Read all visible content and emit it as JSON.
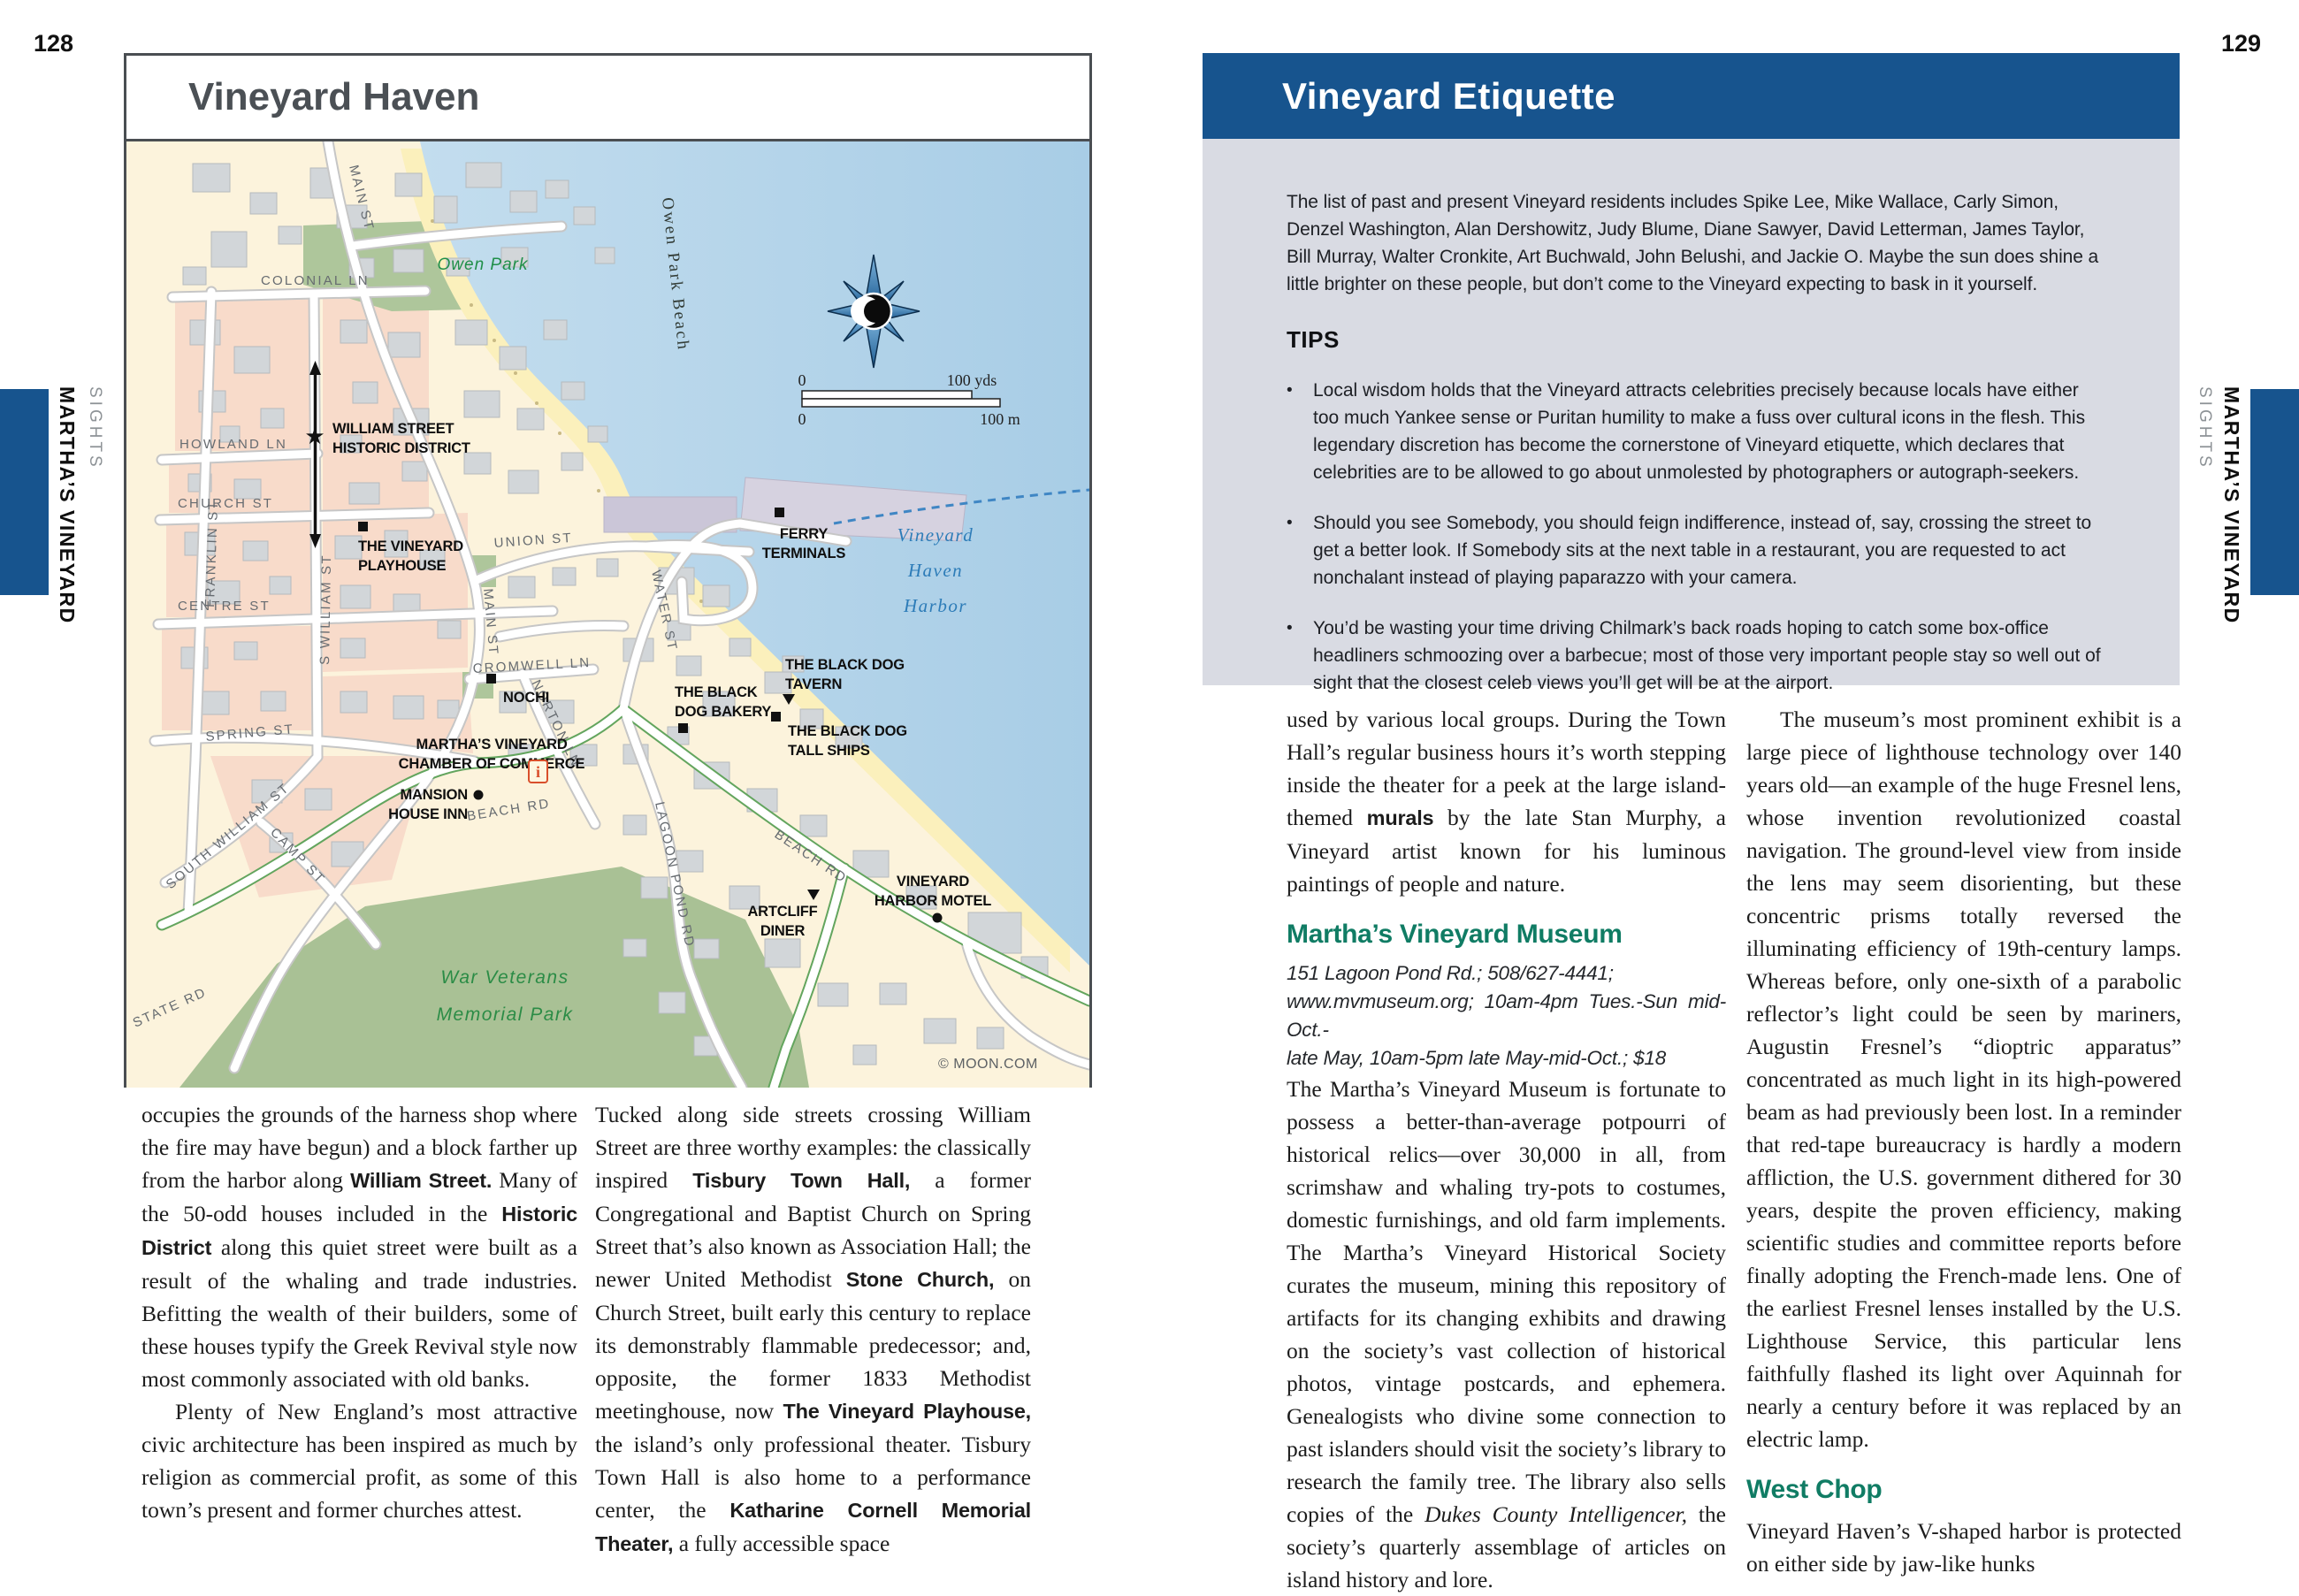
{
  "colors": {
    "accent_blue": "#17548e",
    "teal_heading": "#107c64",
    "box_bg": "#d9dbe3",
    "map_water": "#b9d8ec",
    "map_land": "#fcf3dc",
    "map_pink": "#f8dbca",
    "map_park": "#aec69b"
  },
  "pages": {
    "left_number": "128",
    "right_number": "129"
  },
  "side_tabs": {
    "left": {
      "chapter": "MARTHA’S VINEYARD",
      "section": "SIGHTS"
    },
    "right": {
      "chapter": "MARTHA’S VINEYARD",
      "section": "SIGHTS"
    }
  },
  "map": {
    "title": "Vineyard Haven",
    "copyright": "© MOON.COM",
    "scale": {
      "yds0": "0",
      "yds": "100 yds",
      "m0": "0",
      "m": "100 m"
    },
    "streets": {
      "main_top": "MAIN ST",
      "colonial": "COLONIAL LN",
      "howland": "HOWLAND LN",
      "church": "CHURCH ST",
      "franklin": "FRANKLIN ST",
      "centre": "CENTRE ST",
      "spring": "SPRING ST",
      "s_william": "S WILLIAM ST",
      "south_william": "SOUTH WILLIAM ST",
      "camp": "CAMP ST",
      "main_lower": "MAIN ST",
      "union": "UNION ST",
      "cromwell": "CROMWELL LN",
      "norton": "NORTON LN",
      "water": "WATER ST",
      "lagoon": "LAGOON POND RD",
      "beach_up": "BEACH RD",
      "beach_low": "BEACH RD",
      "state": "STATE RD"
    },
    "pois": {
      "historic_district": [
        "WILLIAM STREET",
        "HISTORIC DISTRICT"
      ],
      "playhouse": [
        "THE VINEYARD",
        "PLAYHOUSE"
      ],
      "ferry": [
        "FERRY",
        "TERMINALS"
      ],
      "nochi": [
        "NOCHI"
      ],
      "chamber": [
        "MARTHA’S VINEYARD",
        "CHAMBER OF COMMERCE"
      ],
      "mansion": [
        "MANSION",
        "HOUSE INN"
      ],
      "tavern": [
        "THE BLACK DOG",
        "TAVERN"
      ],
      "bakery": [
        "THE BLACK",
        "DOG BAKERY"
      ],
      "tall_ships": [
        "THE BLACK DOG",
        "TALL SHIPS"
      ],
      "artcliff": [
        "ARTCLIFF",
        "DINER"
      ],
      "motel": [
        "VINEYARD",
        "HARBOR MOTEL"
      ]
    },
    "areas": {
      "owen_park": "Owen Park",
      "owen_park_beach": "Owen Park Beach",
      "war_memorial": [
        "War Veterans",
        "Memorial Park"
      ],
      "harbor": [
        "Vineyard",
        "Haven",
        "Harbor"
      ]
    }
  },
  "etiquette_box": {
    "title": "Vineyard Etiquette",
    "intro": "The list of past and present Vineyard residents includes Spike Lee, Mike Wallace, Carly Simon, Denzel Washington, Alan Dershowitz, Judy Blume, Diane Sawyer, David Letterman, James Taylor, Bill Murray, Walter Cronkite, Art Buchwald, John Belushi, and Jackie O. Maybe the sun does shine a little brighter on these people, but don’t come to the Vineyard expecting to bask in it yourself.",
    "tips_heading": "TIPS",
    "bullet": "•",
    "tips": [
      "Local wisdom holds that the Vineyard attracts celebrities precisely because locals have either too much Yankee sense or Puritan humility to make a fuss over cultural icons in the flesh. This legendary discretion has become the cornerstone of Vineyard etiquette, which declares that celebrities are to be allowed to go about unmolested by photographers or autograph-seekers.",
      "Should you see Somebody, you should feign indifference, instead of, say, crossing the street to get a better look. If Somebody sits at the next table in a restaurant, you are requested to act nonchalant instead of playing paparazzo with your camera.",
      "You’d be wasting your time driving Chilmark’s back roads hoping to catch some box-office headliners schmoozing over a barbecue; most of those very important people stay so well out of sight that the closest celeb views you’ll get will be at the airport."
    ]
  },
  "left_page": {
    "col1_p1": [
      {
        "t": "occupies the grounds of the harness shop where the fire may have begun) and a block farther up from the harbor along ",
        "s": ""
      },
      {
        "t": "William Street.",
        "s": "b"
      },
      {
        "t": " Many of the 50-odd houses included in the ",
        "s": ""
      },
      {
        "t": "Historic District",
        "s": "b"
      },
      {
        "t": " along this quiet street were built as a result of the whaling and trade industries. Befitting the wealth of their builders, some of these houses typify the Greek Revival style now most commonly associated with old banks.",
        "s": ""
      }
    ],
    "col1_p2": [
      {
        "t": "Plenty of New England’s most attractive civic architecture has been inspired as much by religion as commercial profit, as some of this town’s present and former churches attest.",
        "s": ""
      }
    ],
    "col2_p1": [
      {
        "t": "Tucked along side streets crossing William Street are three worthy examples: the classically inspired ",
        "s": ""
      },
      {
        "t": "Tisbury Town Hall,",
        "s": "b"
      },
      {
        "t": " a former Congregational and Baptist Church on Spring Street that’s also known as Association Hall; the newer United Methodist ",
        "s": ""
      },
      {
        "t": "Stone Church,",
        "s": "b"
      },
      {
        "t": " on Church Street, built early this century to replace its demonstrably flammable predecessor; and, opposite, the former 1833 Methodist meetinghouse, now ",
        "s": ""
      },
      {
        "t": "The Vineyard Playhouse,",
        "s": "b"
      },
      {
        "t": " the island’s only professional theater. Tisbury Town Hall is also home to a performance center, the ",
        "s": ""
      },
      {
        "t": "Katharine Cornell Memorial Theater,",
        "s": "b"
      },
      {
        "t": " a fully accessible space",
        "s": ""
      }
    ]
  },
  "right_page": {
    "col1_p1": [
      {
        "t": "used by various local groups. During the Town Hall’s regular business hours it’s worth stepping inside the theater for a peek at the large island-themed ",
        "s": ""
      },
      {
        "t": "murals",
        "s": "b"
      },
      {
        "t": " by the late Stan Murphy, a Vineyard artist known for his luminous paintings of people and nature.",
        "s": ""
      }
    ],
    "museum_heading": "Martha’s Vineyard Museum",
    "museum_info": [
      "151 Lagoon Pond Rd.; 508/627-4441;",
      "www.mvmuseum.org; 10am-4pm Tues.-Sun mid-Oct.-",
      "late May, 10am-5pm late May-mid-Oct.; $18"
    ],
    "col1_p2": [
      {
        "t": "The Martha’s Vineyard Museum is fortunate to possess a better-than-average potpourri of historical relics—over 30,000 in all, from scrimshaw and whaling try-pots to costumes, domestic furnishings, and old farm implements. The Martha’s Vineyard Historical Society curates the museum, mining this repository of artifacts for its changing exhibits and drawing on the society’s vast collection of historical photos, vintage postcards, and ephemera. Genealogists who divine some connection to past islanders should visit the society’s library to research the family tree. The library also sells copies of the ",
        "s": ""
      },
      {
        "t": "Dukes County Intelligencer,",
        "s": "i"
      },
      {
        "t": " the society’s quarterly assemblage of articles on island history and lore.",
        "s": ""
      }
    ],
    "col2_p1": [
      {
        "t": "The museum’s most prominent exhibit is a large piece of lighthouse technology over 140 years old—an example of the huge Fresnel lens, whose invention revolutionized coastal navigation. The ground-level view from inside the lens may seem disorienting, but these concentric prisms totally reversed the illuminating efficiency of 19th-century lamps. Whereas before, only one-sixth of a parabolic reflector’s light could be seen by mariners, Augustin Fresnel’s “dioptric apparatus” concentrated as much light in its high-powered beam as had previously been lost. In a reminder that red-tape bureaucracy is hardly a modern affliction, the U.S. government dithered for 30 years, despite the proven efficiency, making scientific studies and committee reports before finally adopting the French-made lens. One of the earliest Fresnel lenses installed by the U.S. Lighthouse Service, this particular lens faithfully flashed its light over Aquinnah for nearly a century before it was replaced by an electric lamp.",
        "s": ""
      }
    ],
    "west_chop_heading": "West Chop",
    "col2_p2": [
      {
        "t": "Vineyard Haven’s V-shaped harbor is protected on either side by jaw-like hunks",
        "s": ""
      }
    ]
  }
}
